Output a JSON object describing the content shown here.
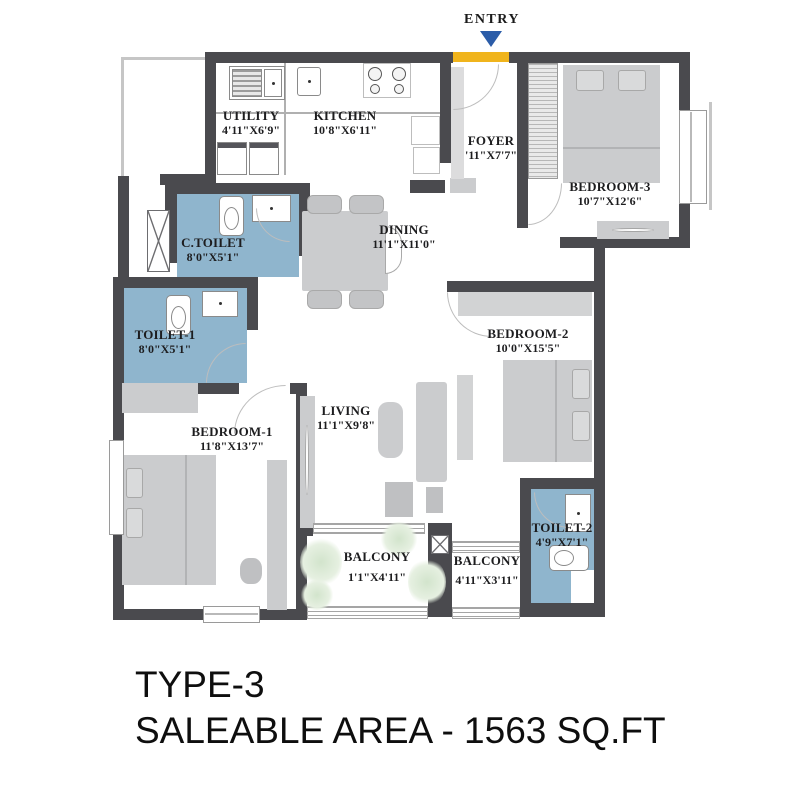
{
  "title": {
    "line1": "TYPE-3",
    "line2": "SALEABLE AREA - 1563 SQ.FT"
  },
  "entry": {
    "label": "ENTRY"
  },
  "rooms": [
    {
      "id": "utility",
      "name": "UTILITY",
      "dims": "4'11\"X6'9\""
    },
    {
      "id": "kitchen",
      "name": "KITCHEN",
      "dims": "10'8\"X6'11\""
    },
    {
      "id": "foyer",
      "name": "FOYER",
      "dims": "'11\"X7'7\""
    },
    {
      "id": "bedroom3",
      "name": "BEDROOM-3",
      "dims": "10'7\"X12'6\""
    },
    {
      "id": "ctoilet",
      "name": "C.TOILET",
      "dims": "8'0\"X5'1\""
    },
    {
      "id": "dining",
      "name": "DINING",
      "dims": "11'1\"X11'0\""
    },
    {
      "id": "toilet1",
      "name": "TOILET-1",
      "dims": "8'0\"X5'1\""
    },
    {
      "id": "bedroom2",
      "name": "BEDROOM-2",
      "dims": "10'0\"X15'5\""
    },
    {
      "id": "bedroom1",
      "name": "BEDROOM-1",
      "dims": "11'8\"X13'7\""
    },
    {
      "id": "living",
      "name": "LIVING",
      "dims": "11'1\"X9'8\""
    },
    {
      "id": "toilet2",
      "name": "TOILET-2",
      "dims": "4'9\"X7'1\""
    },
    {
      "id": "balcony1",
      "name": "BALCONY",
      "dims": "1'1\"X4'11\""
    },
    {
      "id": "balcony2",
      "name": "BALCONY",
      "dims": "4'11\"X3'11\""
    }
  ],
  "colors": {
    "wall": "#4a4a4e",
    "toilet_blue": "#8fb5cd",
    "entry_gold": "#f0b41c",
    "entry_arrow_blue": "#2b5ca8",
    "furniture_gray": "#cbccce"
  }
}
